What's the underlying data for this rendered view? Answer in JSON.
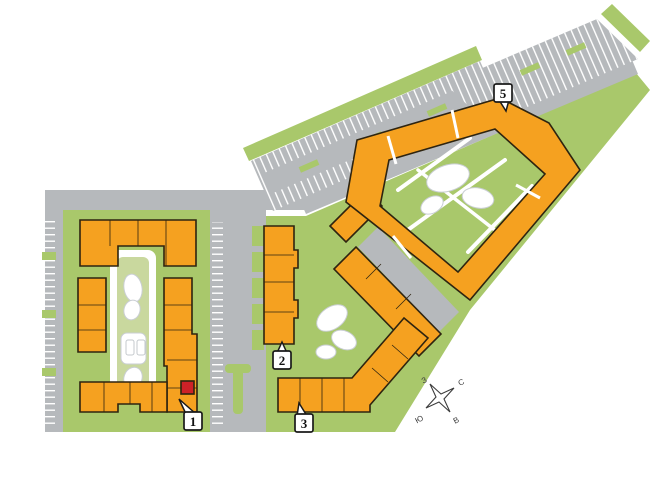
{
  "map": {
    "title": "apartment-community-site-plan",
    "buildings": [
      {
        "id": "1",
        "label": "1",
        "shape": "U-quad courtyard building",
        "has_selected_unit": true
      },
      {
        "id": "2",
        "label": "2",
        "shape": "vertical slab"
      },
      {
        "id": "3",
        "label": "3",
        "shape": "angled L slab"
      },
      {
        "id": "5",
        "label": "5",
        "shape": "pentagon ring with courtyard"
      }
    ],
    "unlabeled_buildings": [
      "small diagonal slab near road bend",
      "mid diagonal slab"
    ],
    "selected_unit": {
      "building": "1",
      "color": "#CE2127"
    },
    "compass": {
      "north": "С",
      "east": "В",
      "south": "Ю",
      "west": "З"
    },
    "colors": {
      "building": "#F5A120",
      "building_outline": "#2E2410",
      "selected_unit": "#CE2127",
      "landscape": "#A9C86B",
      "landscape_light": "#C9D89E",
      "road": "#B6B9BC",
      "parking_stripe": "#FFFFFF",
      "path_outline": "#C9CED3",
      "background": "#FFFFFF",
      "label_bg": "#FFFFFF",
      "label_border": "#1A1A1A"
    }
  }
}
